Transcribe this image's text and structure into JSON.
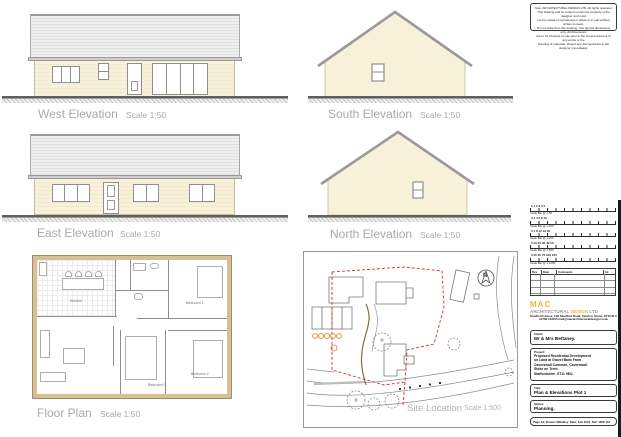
{
  "sheet": {
    "notes": [
      "Note: ARCHITECTURAL DESIGN LTD. All rights reserved.",
      "This drawing and its content remain the property of the designer and must",
      "not be copied or reproduced in whole or in part without written consent.",
      "Do not scale from this drawing. Use figured dimensions only. All dimensions",
      "are to be checked on site prior to the commencement of any works or the",
      "ordering of materials. Report any discrepancies to the designer immediately."
    ]
  },
  "elevations": {
    "west": {
      "label": "West Elevation",
      "scale": "Scale 1:50"
    },
    "south": {
      "label": "South Elevation",
      "scale": "Scale 1:50"
    },
    "east": {
      "label": "East Elevation",
      "scale": "Scale 1:50"
    },
    "north": {
      "label": "North Elevation",
      "scale": "Scale 1:50"
    }
  },
  "floor_plan": {
    "label": "Floor Plan",
    "scale": "Scale 1:50",
    "rooms": [
      "Kitchen",
      "Bedroom 1",
      "Bedroom 2",
      "Bedroom 3"
    ]
  },
  "site_location": {
    "label": "Site Location",
    "scale": "Scale 1:500",
    "north_marker": "N"
  },
  "title_block": {
    "scale_bars": [
      {
        "numbers": "0 1 2 3 4 5",
        "label": "Scale Bar @ 1:50"
      },
      {
        "numbers": "0 2 4 6 8 10",
        "label": "Scale Bar @ 1:100"
      },
      {
        "numbers": "0 4 8 12 16 20",
        "label": "Scale Bar @ 1:200"
      },
      {
        "numbers": "0 10 20 30 40 50",
        "label": "Scale Bar @ 1:500"
      },
      {
        "numbers": "0 25 50 75 100 125",
        "label": "Scale Bar @ 1:1250"
      }
    ],
    "revision_table": {
      "headers": [
        "Rev",
        "Date",
        "Comments",
        "Int"
      ]
    },
    "logo": {
      "name": "MAC",
      "tagline_part1": "ARCHITECTURAL ",
      "tagline_part2": "DESIGN",
      "tagline_part3": " LTD",
      "address_line_1": "Sandford House, 128 Sandford Road, Sandon, Stone, ST15 8LU",
      "address_line_2": "01782 123456   mail@macarchitecturaldesign.co.uk"
    },
    "client": {
      "label": "Client:",
      "value": "Mr & Mrs Bettaney."
    },
    "project": {
      "label": "Project:",
      "lines": [
        "Proposed Residential Development",
        "on Land at Gravel Bank Farm",
        "Caverswall Common, Caverswall.",
        "Stoke on Trent.",
        "Staffordshire. ST11 9EU."
      ]
    },
    "title": {
      "label": "Title:",
      "value": "Plan & Elevations  Plot 1"
    },
    "status": {
      "label": "Status:",
      "value": "Planning."
    },
    "footer": "Page A3. Drawn: MOakley. Date: Feb 2021. Ref: 1878 101"
  },
  "colors": {
    "wall_cream": "#F8F1D9",
    "roof_grey": "#EAEAEA",
    "plan_wall_tan": "#D8BF95",
    "boundary_red": "#CC3333",
    "accent_yellow": "#E8B83A",
    "label_grey": "#A9A9A9"
  }
}
